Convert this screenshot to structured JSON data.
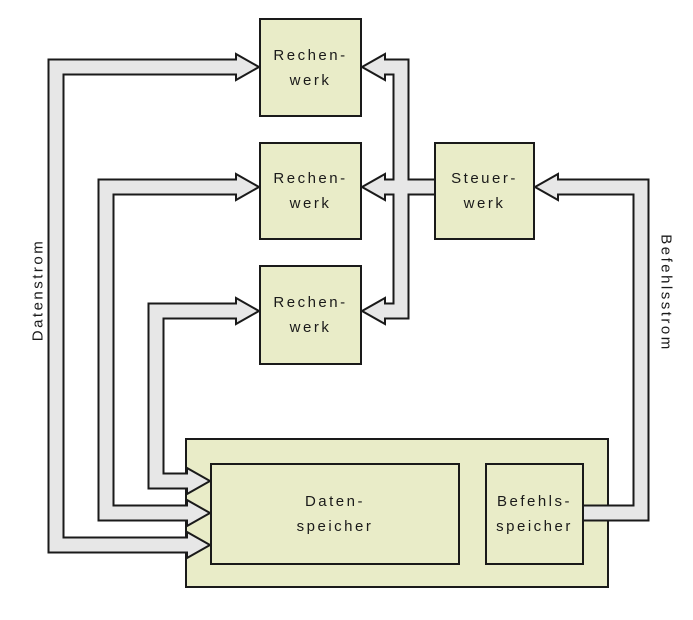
{
  "colors": {
    "box_fill": "#e9ecc8",
    "pipe_fill": "#e7e7e7",
    "outline": "#1a1a1a",
    "background": "#ffffff"
  },
  "units": {
    "rechenwerk": {
      "line1": "Rechen-",
      "line2": "werk"
    },
    "steuerwerk": {
      "line1": "Steuer-",
      "line2": "werk"
    },
    "datenspeicher": {
      "line1": "Daten-",
      "line2": "speicher"
    },
    "befehlsspeicher": {
      "line1": "Befehls-",
      "line2": "speicher"
    }
  },
  "streams": {
    "datenstrom": "Datenstrom",
    "befehlsstrom": "Befehlsstrom"
  }
}
